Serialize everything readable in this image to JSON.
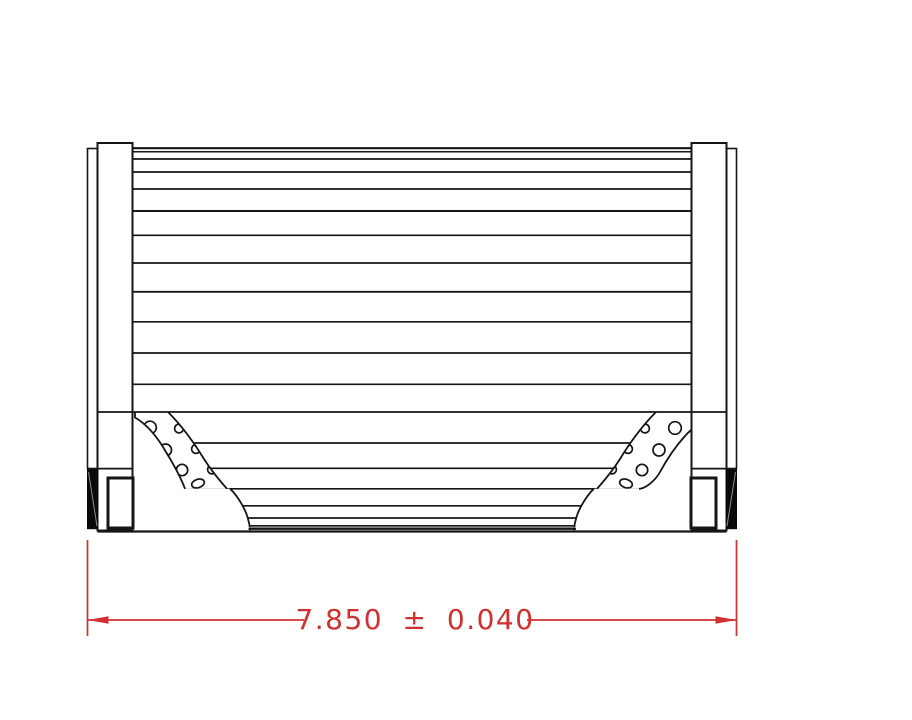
{
  "drawing": {
    "background_color": "#ffffff",
    "stroke_color": "#161616",
    "type": "technical-drawing-filter-element-side-view"
  },
  "dimension": {
    "label": "7.850 ± 0.040",
    "value": "7.850",
    "tolerance_symbol": "±",
    "tolerance": "0.040",
    "color": "#d03030"
  }
}
